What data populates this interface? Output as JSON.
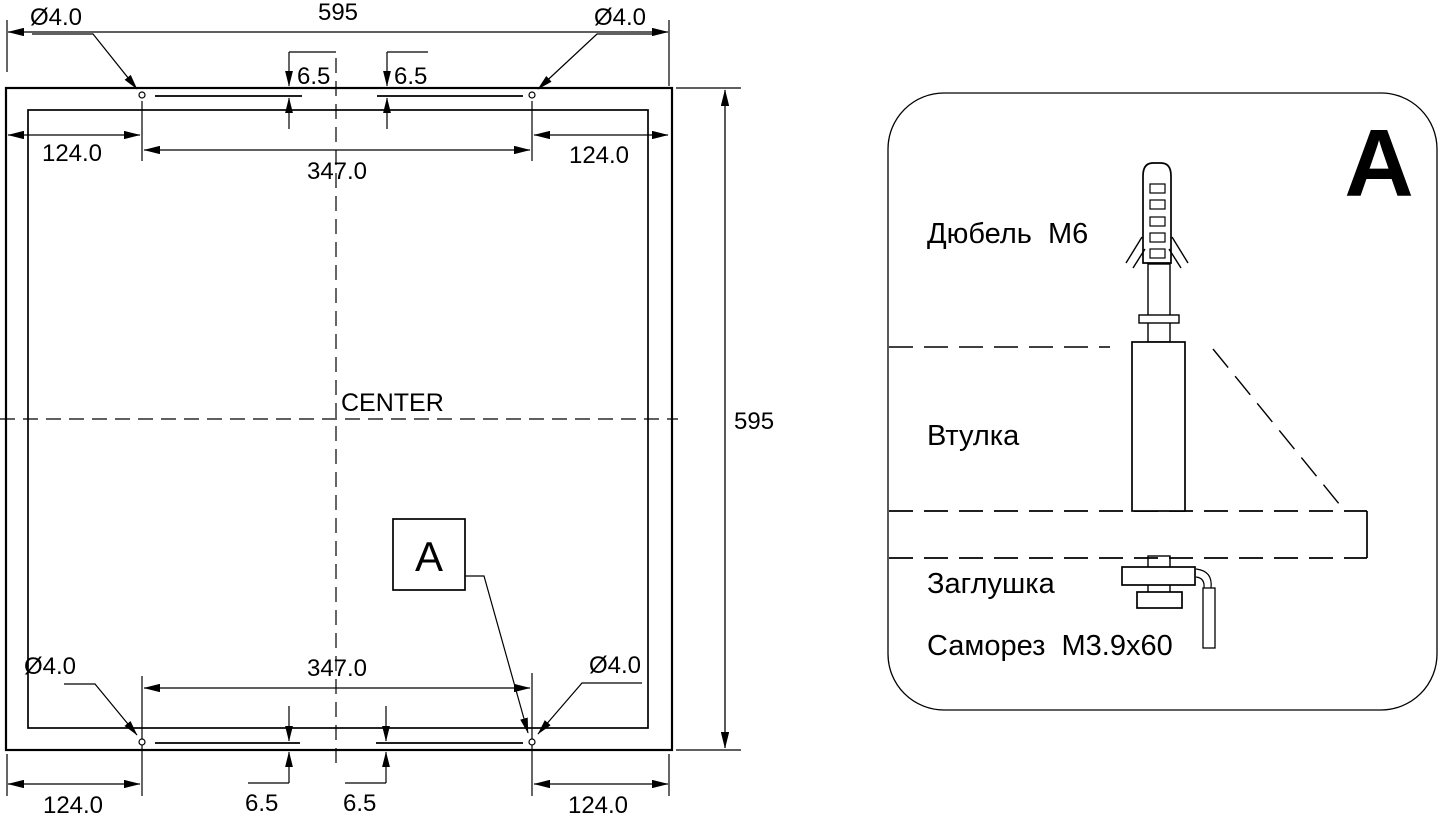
{
  "plan": {
    "center_label": "CENTER",
    "callout": "A",
    "dim_width": "595",
    "dim_height": "595",
    "holes": {
      "top_left": "Ø4.0",
      "top_right": "Ø4.0",
      "bottom_left": "Ø4.0",
      "bottom_right": "Ø4.0"
    },
    "offsets": {
      "top_left": "124.0",
      "top_right": "124.0",
      "bottom_left": "124.0",
      "bottom_right": "124.0"
    },
    "spans": {
      "top": "347.0",
      "bottom": "347.0"
    },
    "slots": {
      "top_left": "6.5",
      "top_right": "6.5",
      "bottom_left": "6.5",
      "bottom_right": "6.5"
    }
  },
  "detail": {
    "view_label": "A",
    "labels": {
      "dowel": "Дюбель  М6",
      "bushing": "Втулка",
      "plug": "Заглушка",
      "screw": "Саморез  М3.9х60"
    }
  },
  "colors": {
    "ink": "#000000",
    "paper": "#ffffff"
  }
}
